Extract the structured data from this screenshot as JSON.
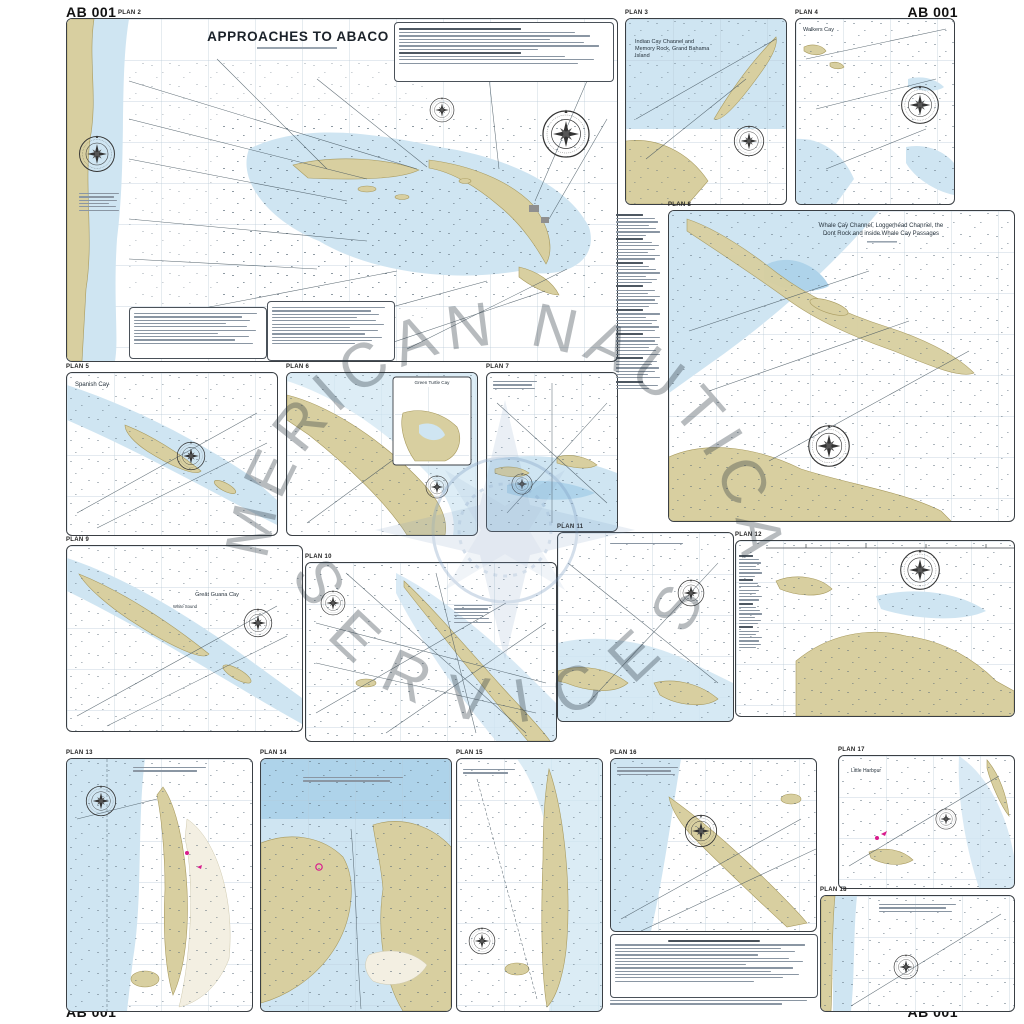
{
  "sheet": {
    "code": "AB 001"
  },
  "watermark": {
    "text_top": "AMERICAN NAUTICAL",
    "text_bottom": "SERVICES"
  },
  "colors": {
    "water_shallow": "#cfe5f2",
    "water_deep": "#aed3ea",
    "land": "#d8cfa0",
    "urban_gray": "#8f8f8f",
    "magenta_aid": "#d81b8c",
    "watermark_blue": "#7d9cc0"
  },
  "plans": {
    "p2": {
      "label": "PLAN 2",
      "title": "APPROACHES TO ABACO"
    },
    "p3": {
      "label": "PLAN 3",
      "title1": "Indian Cay Channel and",
      "title2": "Memory Rock, Grand Bahama",
      "title3": "Island"
    },
    "p4": {
      "label": "PLAN 4",
      "title": "Walkers Cay"
    },
    "p5": {
      "label": "PLAN 5",
      "title": "Spanish Cay"
    },
    "p6": {
      "label": "PLAN 6",
      "inset_title": "Green Turtle Cay"
    },
    "p7": {
      "label": "PLAN 7"
    },
    "p8": {
      "label": "PLAN 8",
      "title1": "Whale Cay Channel, Loggerhead Channel, the",
      "title2": "Dont Rock and inside Whale Cay Passages"
    },
    "p9": {
      "label": "PLAN 9",
      "title": "Great Guana Cay",
      "subtitle": "White Sound"
    },
    "p10": {
      "label": "PLAN 10"
    },
    "p11": {
      "label": "PLAN 11"
    },
    "p12": {
      "label": "PLAN 12"
    },
    "p13": {
      "label": "PLAN 13"
    },
    "p14": {
      "label": "PLAN 14"
    },
    "p15": {
      "label": "PLAN 15"
    },
    "p16": {
      "label": "PLAN 16"
    },
    "p17": {
      "label": "PLAN 17",
      "title": "Little Harbour"
    },
    "p18": {
      "label": "PLAN 18"
    }
  }
}
